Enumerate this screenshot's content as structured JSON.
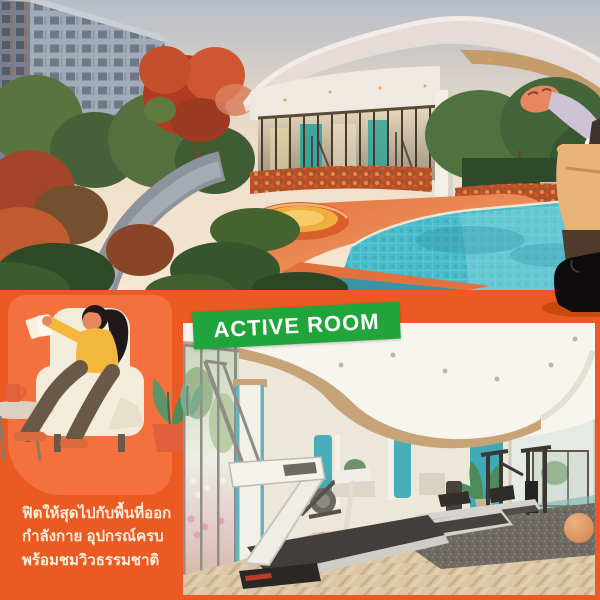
{
  "banner": {
    "label": "ACTIVE ROOM",
    "bg_color": "#1FA53C",
    "text_color": "#FFFFFF"
  },
  "caption": {
    "line1": "ฟิตให้สุดไปกับพื้นที่ออก",
    "line2": "กำลังกาย อุปกรณ์ครบ",
    "line3": "พร้อมชมวิวธรรมชาติ",
    "text_color": "#FBEEDA"
  },
  "illustrations": {
    "bottom_left": "woman-reading-in-armchair-with-mug-and-plant",
    "top_right": "waving-person-with-bag-and-boots",
    "photo_top": "condo-courtyard-pool-and-glass-pavilion-render",
    "photo_bottom": "fitness-room-with-treadmills-and-machines-render"
  },
  "colors": {
    "panel_orange": "#EC5A23",
    "panel_orange_light": "#F4703F",
    "banner_green": "#1FA53C",
    "caption_cream": "#FBEEDA",
    "pool_turquoise": "#49BCCB",
    "deck_orange": "#E3703B",
    "spa_yellow": "#F0AE3F",
    "teal_wall": "#3FA9B6",
    "wood_floor": "#D8C2A4",
    "sweater_yellow": "#F4B73E",
    "pants_brown": "#6B5847",
    "skin": "#E8875F",
    "chair_cream": "#F2ECDA",
    "boot_black": "#0E0C0C"
  }
}
